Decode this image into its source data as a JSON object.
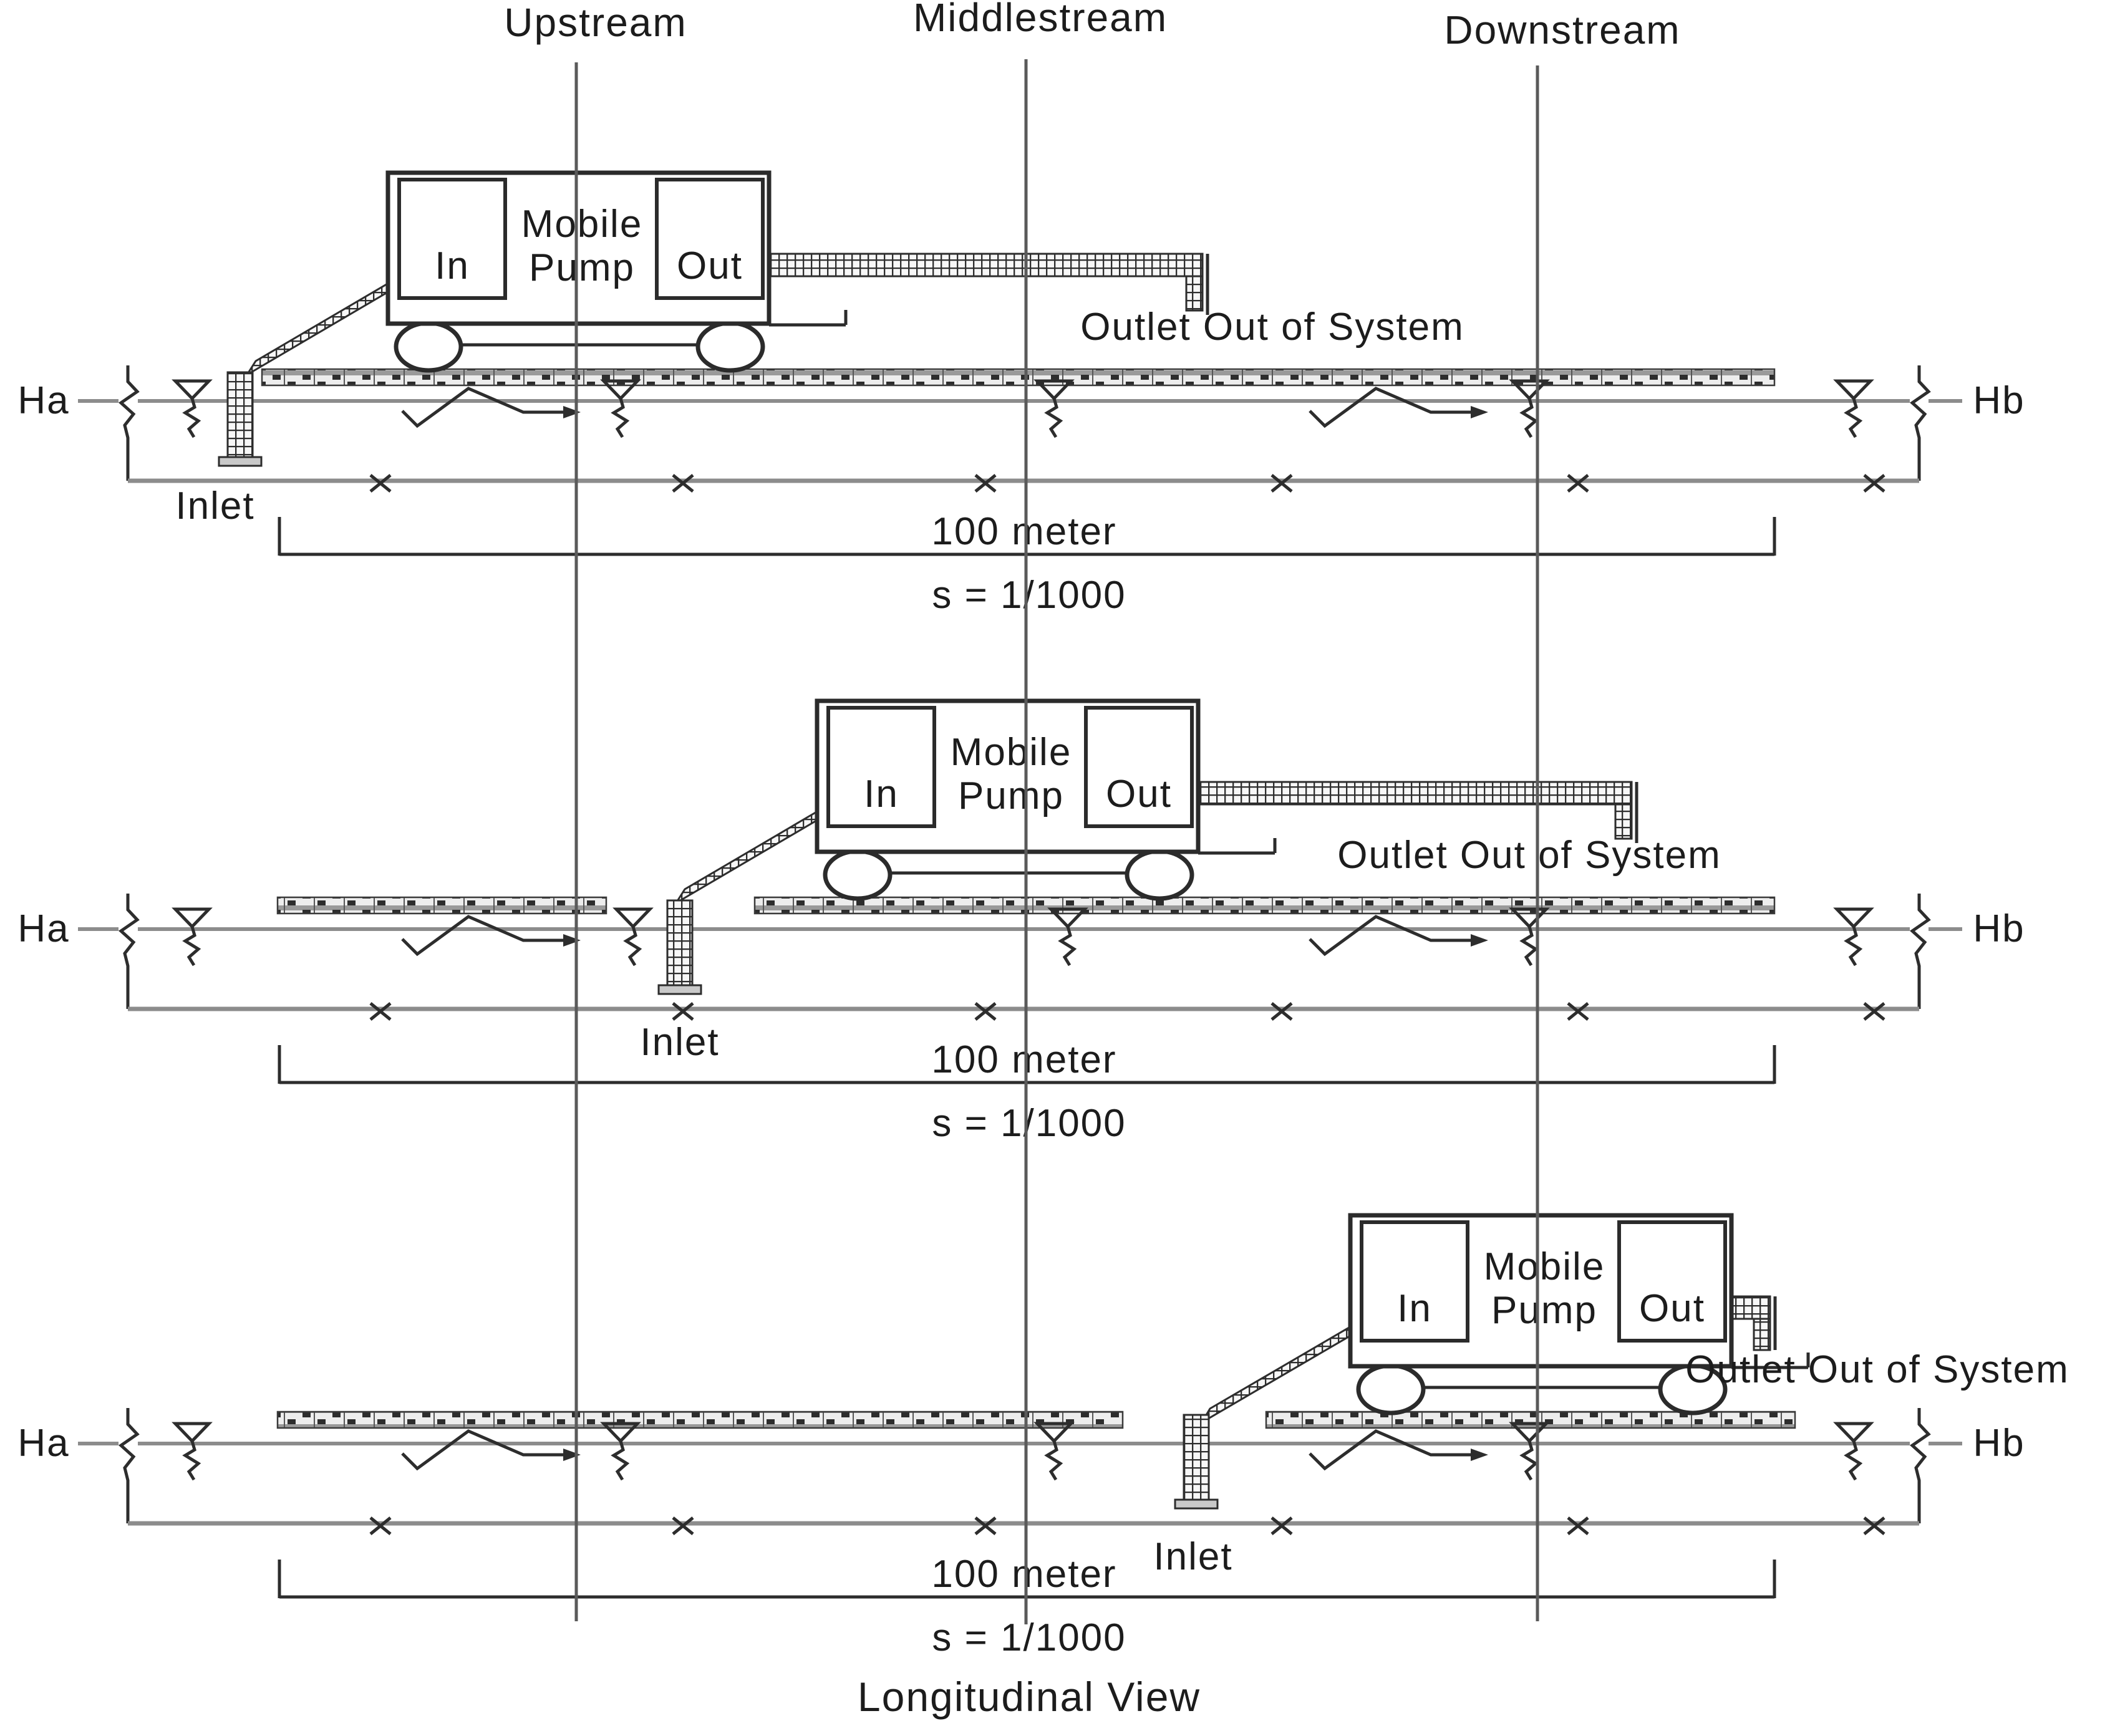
{
  "diagram": {
    "caption": "Longitudinal View",
    "stream_labels": [
      "Upstream",
      "Middlestream",
      "Downstream"
    ],
    "labels": {
      "water_left": "Ha",
      "water_right": "Hb",
      "inlet": "Inlet",
      "outlet": "Outlet Out of System",
      "dimension": "100 meter",
      "slope": "s = 1/1000",
      "pump_name_1": "Mobile",
      "pump_name_2": "Pump",
      "pump_in": "In",
      "pump_out": "Out"
    },
    "panels": [
      {
        "pump_position": "Upstream"
      },
      {
        "pump_position": "Middlestream"
      },
      {
        "pump_position": "Downstream"
      }
    ],
    "colors": {
      "line_dark": "#2d2d2d",
      "line_gray": "#8c8c8c",
      "deck_fill": "#ededed"
    }
  }
}
